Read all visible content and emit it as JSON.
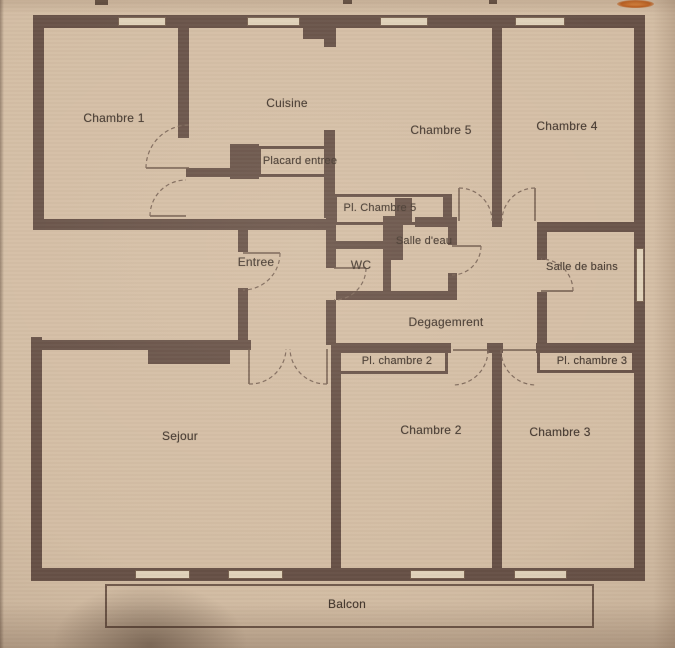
{
  "floor_plan": {
    "rooms": {
      "chambre1": {
        "label": "Chambre 1"
      },
      "cuisine": {
        "label": "Cuisine"
      },
      "placard_entree": {
        "label": "Placard entree"
      },
      "chambre5": {
        "label": "Chambre 5"
      },
      "chambre4": {
        "label": "Chambre 4"
      },
      "pl_chambre5": {
        "label": "Pl. Chambre 5"
      },
      "salle_deau": {
        "label": "Salle d'eau"
      },
      "wc": {
        "label": "WC"
      },
      "entree": {
        "label": "Entree"
      },
      "salle_de_bains": {
        "label": "Salle de bains"
      },
      "degagement": {
        "label": "Degagemrent"
      },
      "pl_chambre2": {
        "label": "Pl. chambre 2"
      },
      "pl_chambre3": {
        "label": "Pl. chambre 3"
      },
      "sejour": {
        "label": "Sejour"
      },
      "chambre2": {
        "label": "Chambre 2"
      },
      "chambre3": {
        "label": "Chambre 3"
      },
      "balcon": {
        "label": "Balcon"
      }
    },
    "colors": {
      "wall": "#665046",
      "paper": "#d3bda4",
      "line": "#77604f",
      "label_text": "#44372e",
      "highlight_mark": "#c05f1d"
    }
  }
}
